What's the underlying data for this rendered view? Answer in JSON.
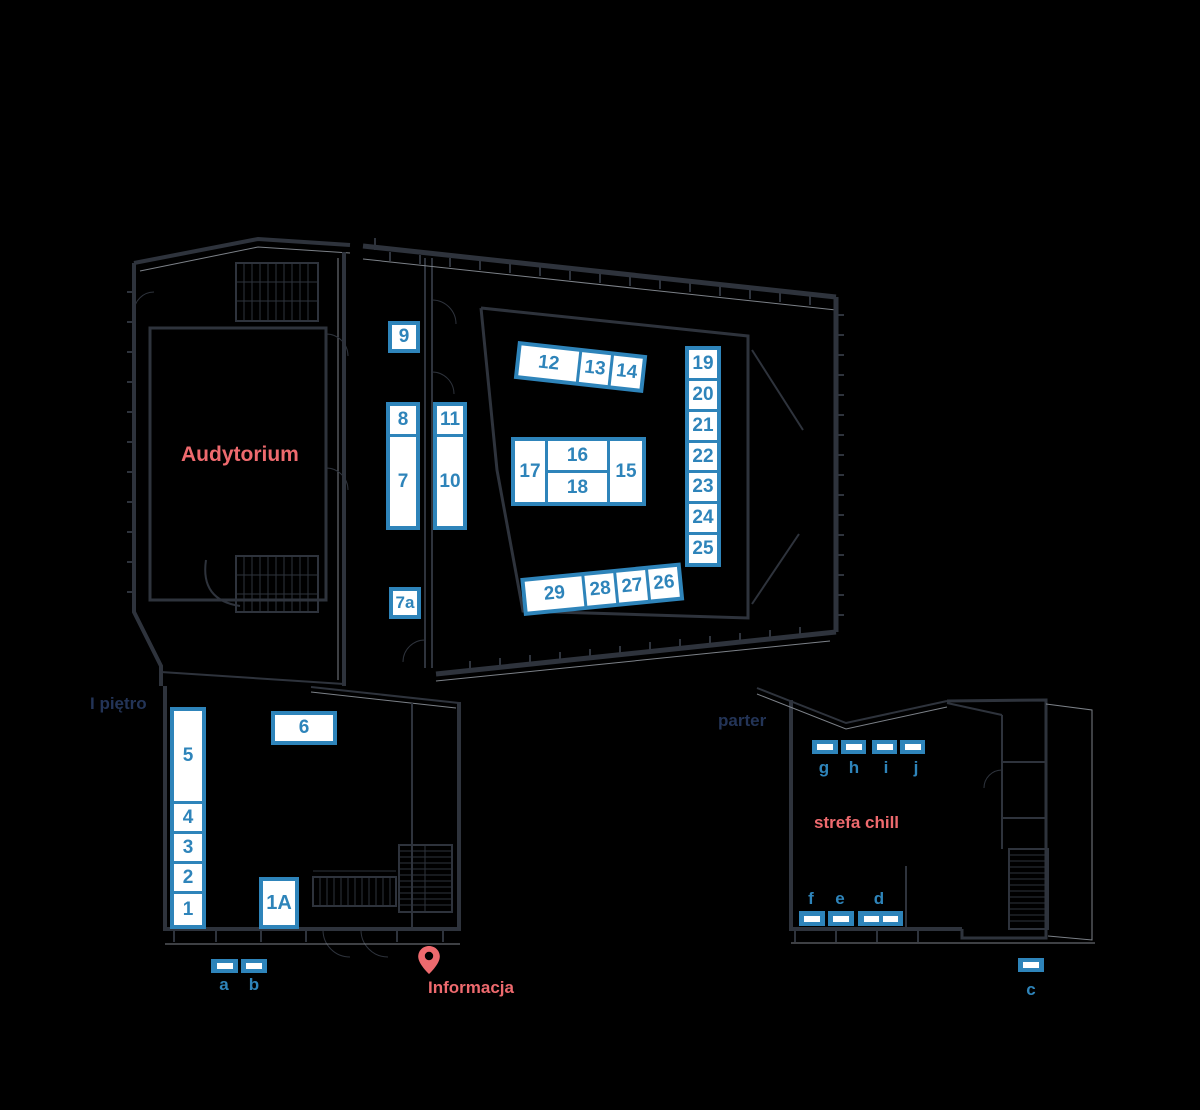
{
  "colors": {
    "background": "#000000",
    "wall_line": "#2e333c",
    "wall_line_light": "#7c8188",
    "booth_blue": "#2e84ba",
    "booth_fill": "#ffffff",
    "accent_coral": "#ee6a6e",
    "navy_label": "#233457"
  },
  "area_labels": {
    "audytorium": "Audytorium",
    "first_floor": "I piętro",
    "ground_floor": "parter",
    "chill_zone": "strefa chill",
    "information": "Informacja"
  },
  "stands": {
    "s1": "1",
    "s1a": "1A",
    "s2": "2",
    "s3": "3",
    "s4": "4",
    "s5": "5",
    "s6": "6",
    "s7": "7",
    "s7a": "7a",
    "s8": "8",
    "s9": "9",
    "s10": "10",
    "s11": "11",
    "s12": "12",
    "s13": "13",
    "s14": "14",
    "s15": "15",
    "s16": "16",
    "s17": "17",
    "s18": "18",
    "s19": "19",
    "s20": "20",
    "s21": "21",
    "s22": "22",
    "s23": "23",
    "s24": "24",
    "s25": "25",
    "s26": "26",
    "s27": "27",
    "s28": "28",
    "s29": "29"
  },
  "letter_stands": {
    "a": "a",
    "b": "b",
    "c": "c",
    "d": "d",
    "e": "e",
    "f": "f",
    "g": "g",
    "h": "h",
    "i": "i",
    "j": "j"
  },
  "icons": {
    "information_pin": "map-pin"
  }
}
